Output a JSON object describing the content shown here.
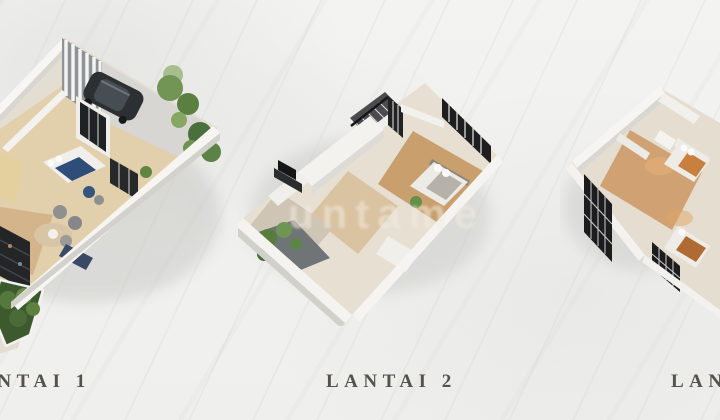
{
  "page": {
    "description": "Three-storey house 3D floor plan showcase on marble background",
    "background_color": "#f2f2f0"
  },
  "watermark": {
    "text": "untame"
  },
  "floors": [
    {
      "label": "LANTAI 1",
      "illustration_elements": [
        "carport-suv-car",
        "vertical-slat-screen",
        "garden-trees",
        "bedroom-blue-bed",
        "living-room-armchairs",
        "round-rug",
        "dark-shelf-partition",
        "hedge-garden",
        "glass-doors"
      ]
    },
    {
      "label": "LANTAI 2",
      "illustration_elements": [
        "staircase-black-railing",
        "black-frame-window-wall",
        "bedroom-bed",
        "tv-console",
        "balcony-plants",
        "white-parapet-walls"
      ]
    },
    {
      "label": "LANTAI 3",
      "illustration_elements": [
        "black-grid-glass-partitions",
        "bedroom-warm-lighting",
        "second-bedroom",
        "bathroom-fixtures",
        "white-walls"
      ]
    }
  ],
  "colors": {
    "label_text": "#55524a",
    "wall_white": "#f6f5f2",
    "floor_wood": "#c9a06d",
    "floor_beige": "#e2d0ad",
    "frame_black": "#1e1e20",
    "tree_green": "#5d8040",
    "car_charcoal": "#2c3032",
    "bed_blue": "#2e4d78",
    "warm_light": "#e8b077"
  }
}
